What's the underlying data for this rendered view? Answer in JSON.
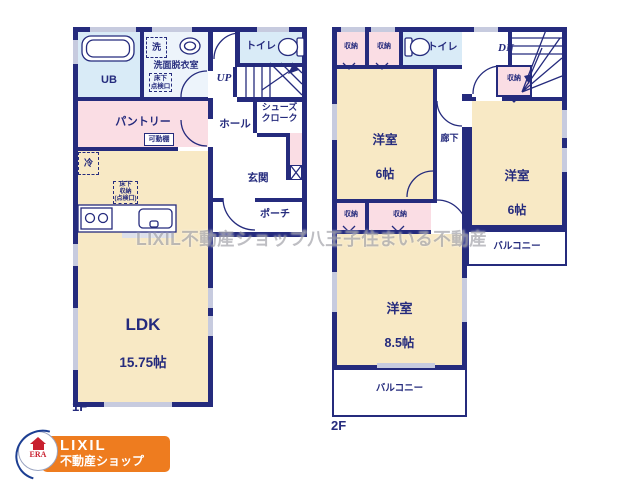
{
  "watermark": "LIXIL不動産ショップ八王子住まいる不動産",
  "colors": {
    "wall": "#252b7d",
    "cream": "#f8e9c5",
    "pink": "#fadde4",
    "bath_blue": "#d9ebf7",
    "washroom_blue": "#edf4fb",
    "window": "#c7cbdf",
    "logo_orange": "#ee7c1f",
    "era_red": "#c8202f",
    "era_blue": "#1c3e92"
  },
  "floor1": {
    "label": "1F",
    "ub": "UB",
    "washer": "洗",
    "washroom": "洗面脱衣室",
    "underfloor_hatch": "床下\n点検口",
    "toilet": "トイレ",
    "stairs_up": "UP",
    "hall": "ホール",
    "shoes_closet": "シューズ\nクローク",
    "pantry": "パントリー",
    "movable_shelf": "可動棚",
    "fridge": "冷",
    "underfloor_storage": "床下\n収納\n(点検口)",
    "entrance": "玄関",
    "porch": "ポーチ",
    "ldk": "LDK",
    "ldk_size": "15.75帖"
  },
  "floor2": {
    "label": "2F",
    "closet_a": "収納",
    "closet_b": "収納",
    "toilet": "トイレ",
    "stairs_down": "DN",
    "closet_c": "収納",
    "room_a": "洋室",
    "room_a_size": "6帖",
    "corridor": "廊下",
    "room_b": "洋室",
    "room_b_size": "6帖",
    "closet_d": "収納",
    "closet_e": "収納",
    "room_c": "洋室",
    "room_c_size": "8.5帖",
    "balcony_right": "バルコニー",
    "balcony_bottom": "バルコニー"
  },
  "logo": {
    "era": "ERA",
    "brand": "LIXIL",
    "sub": "不動産ショップ"
  }
}
